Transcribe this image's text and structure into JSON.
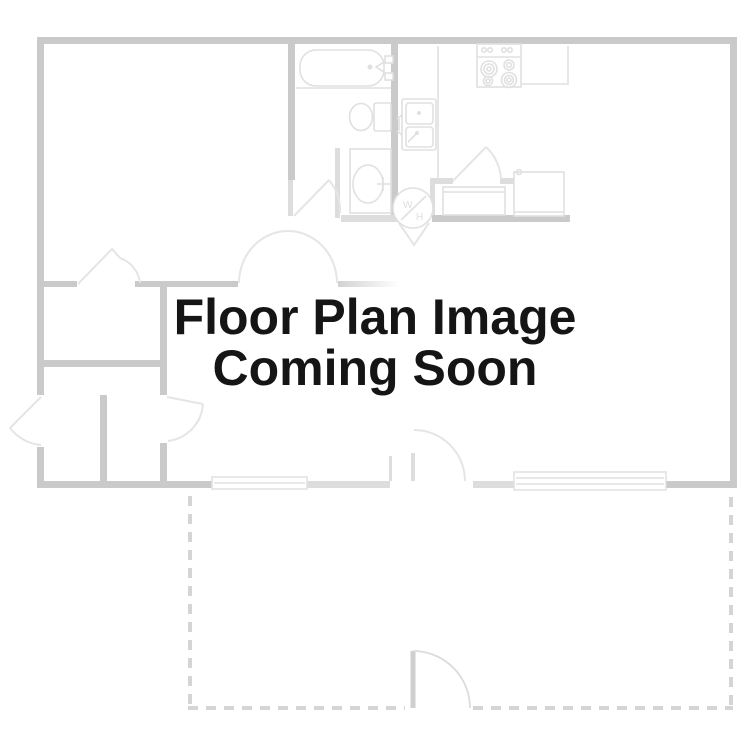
{
  "placeholder_text": {
    "line1": "Floor Plan Image",
    "line2": "Coming Soon"
  },
  "labels": {
    "water_heater": "W/H"
  },
  "colors": {
    "background": "#ffffff",
    "wall": "#cacaca",
    "wall_light": "#dddddd",
    "fixture": "#e0e0e0",
    "door_arc": "#e5e5e5",
    "dashed": "#d5d5d5",
    "text": "#151515"
  },
  "fixture_icons": [
    "bathtub-icon",
    "toilet-icon",
    "vanity-sink-icon",
    "kitchen-double-sink-icon",
    "stove-icon",
    "refrigerator-icon",
    "water-heater-icon",
    "window-icon",
    "door-swing-icon",
    "patio-dashed-outline"
  ]
}
